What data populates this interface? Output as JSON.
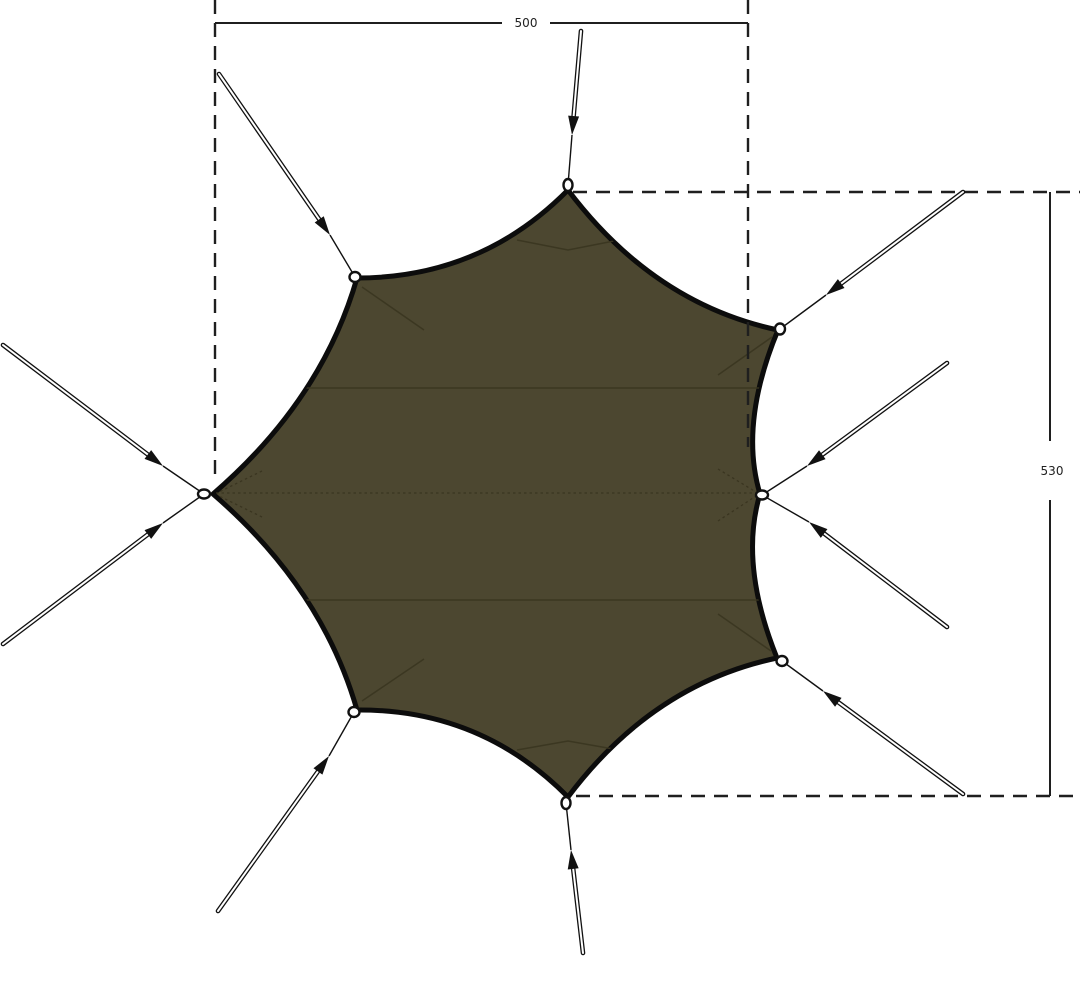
{
  "page": {
    "background": "#ffffff"
  },
  "diagram": {
    "name": "octagonal-tarp-top-view-with-guy-lines-and-dimensions",
    "canvas": {
      "width": 1080,
      "height": 988
    },
    "colors": {
      "background": "#ffffff",
      "canopy_fill": "#4c4730",
      "canopy_edge": "#0c0c0c",
      "seam": "#3a3520",
      "dimension": "#1f1f1f",
      "rope_outline": "#111111",
      "rope_core": "#ffffff",
      "loop_fill": "#ffffff"
    },
    "dimensions": {
      "width": {
        "label": "500",
        "line_y": 23,
        "x1": 215,
        "x2": 748,
        "gap": [
          502,
          550
        ],
        "label_pos": [
          526,
          27
        ],
        "extensions": [
          {
            "x": 215,
            "y1": 0,
            "y2": 478
          },
          {
            "x": 748,
            "y1": 0,
            "y2": 447
          }
        ]
      },
      "height": {
        "label": "530",
        "line_x": 1050,
        "y1": 192,
        "y2": 796,
        "gap": [
          441,
          500
        ],
        "label_pos": [
          1052,
          475
        ],
        "extensions": [
          {
            "y": 192,
            "x1": 573,
            "x2": 1080
          },
          {
            "y": 796,
            "x1": 576,
            "x2": 1080
          }
        ]
      }
    },
    "canopy": {
      "corners": [
        [
          568,
          190
        ],
        [
          778,
          330
        ],
        [
          760,
          494
        ],
        [
          777,
          658
        ],
        [
          568,
          797
        ],
        [
          357,
          710
        ],
        [
          213,
          494
        ],
        [
          357,
          278
        ]
      ],
      "edge_controls": [
        [
          654,
          304
        ],
        [
          739,
          424
        ],
        [
          739,
          564
        ],
        [
          653,
          684
        ],
        [
          481,
          709
        ],
        [
          322,
          588
        ],
        [
          322,
          400
        ],
        [
          481,
          278
        ]
      ],
      "seams_solid": [
        [
          [
            220,
            388
          ],
          [
            790,
            388
          ]
        ],
        [
          [
            220,
            600
          ],
          [
            790,
            600
          ]
        ],
        [
          [
            362,
            287
          ],
          [
            424,
            330
          ]
        ],
        [
          [
            772,
            337
          ],
          [
            718,
            375
          ]
        ],
        [
          [
            362,
            701
          ],
          [
            424,
            659
          ]
        ],
        [
          [
            771,
            651
          ],
          [
            718,
            614
          ]
        ],
        [
          [
            517,
            240
          ],
          [
            568,
            250
          ],
          [
            619,
            240
          ]
        ],
        [
          [
            517,
            750
          ],
          [
            568,
            741
          ],
          [
            619,
            750
          ]
        ]
      ],
      "seams_dotted": [
        [
          [
            216,
            493
          ],
          [
            758,
            493
          ]
        ],
        [
          [
            718,
            469
          ],
          [
            756,
            492
          ]
        ],
        [
          [
            718,
            521
          ],
          [
            756,
            496
          ]
        ],
        [
          [
            262,
            471
          ],
          [
            219,
            492
          ]
        ],
        [
          [
            262,
            517
          ],
          [
            219,
            496
          ]
        ]
      ]
    },
    "tie_outs": [
      {
        "name": "tie-out-top",
        "center": [
          568,
          185
        ],
        "rx": 4.5,
        "ry": 6
      },
      {
        "name": "tie-out-upper-left",
        "center": [
          355,
          277
        ],
        "rx": 5.5,
        "ry": 5
      },
      {
        "name": "tie-out-left",
        "center": [
          204,
          494
        ],
        "rx": 6,
        "ry": 4.5
      },
      {
        "name": "tie-out-lower-left",
        "center": [
          354,
          712
        ],
        "rx": 5.5,
        "ry": 5
      },
      {
        "name": "tie-out-bottom",
        "center": [
          566,
          803
        ],
        "rx": 4.5,
        "ry": 6
      },
      {
        "name": "tie-out-lower-right",
        "center": [
          782,
          661
        ],
        "rx": 5.5,
        "ry": 5
      },
      {
        "name": "tie-out-right",
        "center": [
          762,
          495
        ],
        "rx": 6,
        "ry": 4.5
      },
      {
        "name": "tie-out-upper-right",
        "center": [
          780,
          329
        ],
        "rx": 5,
        "ry": 5.5
      }
    ],
    "guy_lines": [
      {
        "name": "guy-line-top",
        "anchor": [
          581,
          31
        ],
        "arrow": [
          572,
          135
        ],
        "loop": [
          568,
          185
        ]
      },
      {
        "name": "guy-line-upper-left",
        "anchor": [
          219,
          74
        ],
        "arrow": [
          330,
          235
        ],
        "loop": [
          355,
          277
        ]
      },
      {
        "name": "guy-line-left-upper",
        "anchor": [
          3,
          345
        ],
        "arrow": [
          163,
          466
        ],
        "loop": [
          204,
          494
        ]
      },
      {
        "name": "guy-line-left-lower",
        "anchor": [
          3,
          644
        ],
        "arrow": [
          163,
          523
        ],
        "loop": [
          204,
          494
        ]
      },
      {
        "name": "guy-line-lower-left",
        "anchor": [
          218,
          911
        ],
        "arrow": [
          329,
          756
        ],
        "loop": [
          354,
          712
        ]
      },
      {
        "name": "guy-line-bottom",
        "anchor": [
          583,
          953
        ],
        "arrow": [
          571,
          850
        ],
        "loop": [
          566,
          803
        ]
      },
      {
        "name": "guy-line-lower-right",
        "anchor": [
          963,
          794
        ],
        "arrow": [
          823,
          691
        ],
        "loop": [
          782,
          661
        ]
      },
      {
        "name": "guy-line-right-lower",
        "anchor": [
          947,
          627
        ],
        "arrow": [
          809,
          522
        ],
        "loop": [
          762,
          495
        ]
      },
      {
        "name": "guy-line-right-upper",
        "anchor": [
          947,
          363
        ],
        "arrow": [
          807,
          466
        ],
        "loop": [
          762,
          495
        ]
      },
      {
        "name": "guy-line-upper-right",
        "anchor": [
          963,
          192
        ],
        "arrow": [
          826,
          295
        ],
        "loop": [
          780,
          329
        ]
      }
    ],
    "rope_style": {
      "outer_width": 4.6,
      "core_width": 2.0,
      "thin_width": 1.4,
      "arrow_len": 19,
      "arrow_half_width": 5.5
    }
  }
}
